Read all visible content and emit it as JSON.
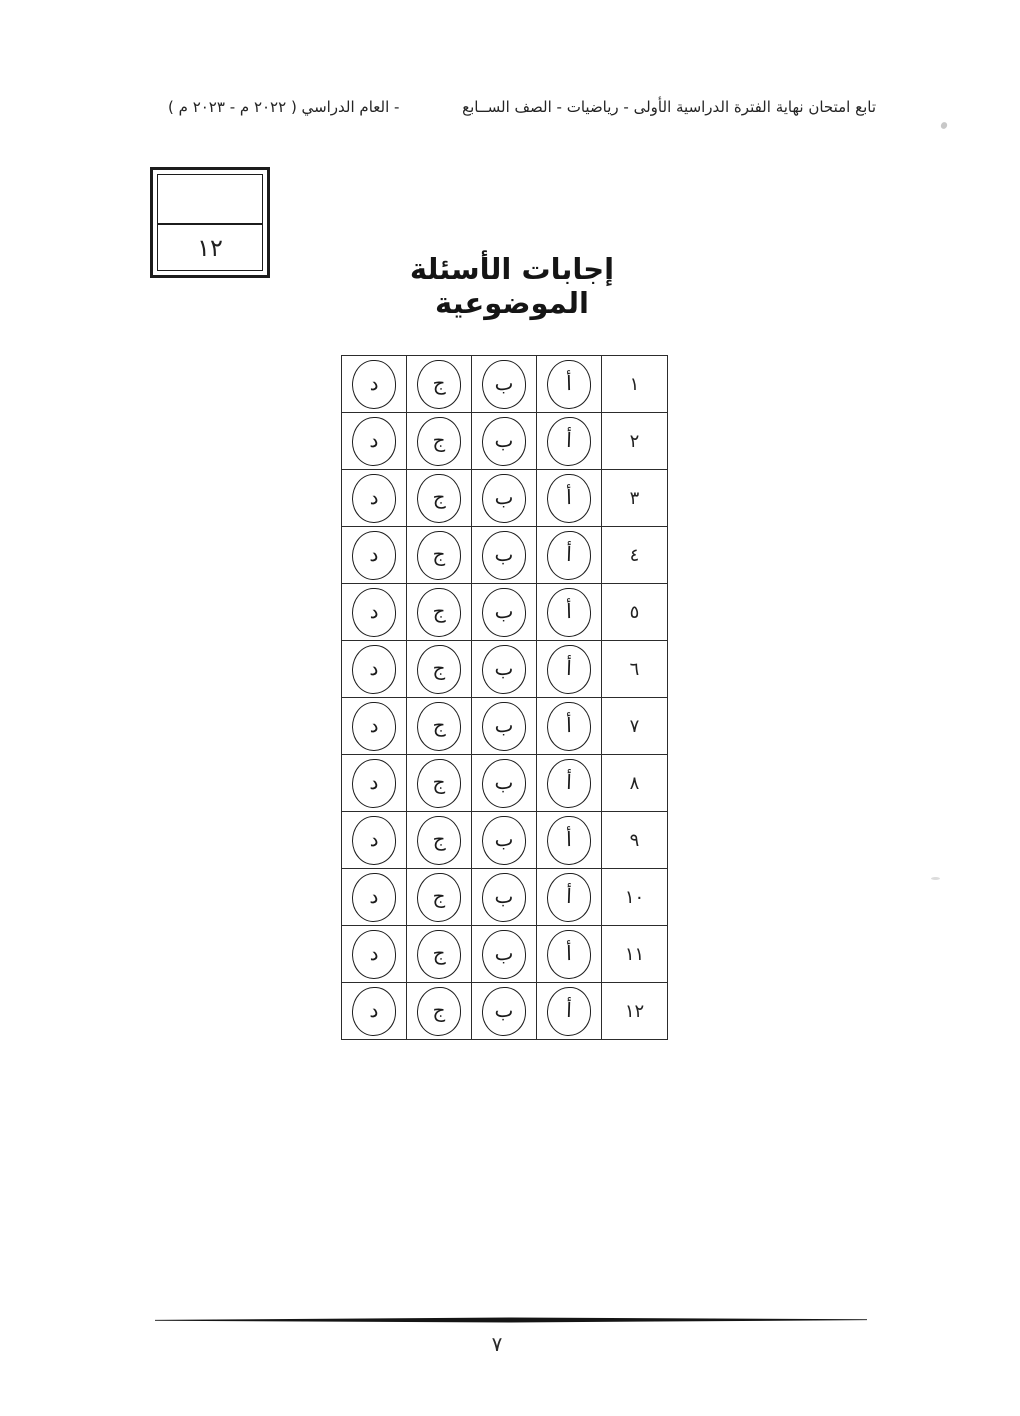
{
  "header": {
    "right_text": "تابع   امتحان نهاية الفترة الدراسية الأولى -  رياضيات - الصف الســابع",
    "left_text": "-  العام الدراسي ( ٢٠٢٢ م  -  ٢٠٢٣ م )"
  },
  "grade_box": {
    "top_value": "",
    "score": "١٢"
  },
  "title": "إجابات الأسئلة الموضوعية",
  "answer_table": {
    "options": [
      "أ",
      "ب",
      "ج",
      "د"
    ],
    "rows": [
      {
        "number": "١",
        "choices": [
          "أ",
          "ب",
          "ج",
          "د"
        ]
      },
      {
        "number": "٢",
        "choices": [
          "أ",
          "ب",
          "ج",
          "د"
        ]
      },
      {
        "number": "٣",
        "choices": [
          "أ",
          "ب",
          "ج",
          "د"
        ]
      },
      {
        "number": "٤",
        "choices": [
          "أ",
          "ب",
          "ج",
          "د"
        ]
      },
      {
        "number": "٥",
        "choices": [
          "أ",
          "ب",
          "ج",
          "د"
        ]
      },
      {
        "number": "٦",
        "choices": [
          "أ",
          "ب",
          "ج",
          "د"
        ]
      },
      {
        "number": "٧",
        "choices": [
          "أ",
          "ب",
          "ج",
          "د"
        ]
      },
      {
        "number": "٨",
        "choices": [
          "أ",
          "ب",
          "ج",
          "د"
        ]
      },
      {
        "number": "٩",
        "choices": [
          "أ",
          "ب",
          "ج",
          "د"
        ]
      },
      {
        "number": "١٠",
        "choices": [
          "أ",
          "ب",
          "ج",
          "د"
        ]
      },
      {
        "number": "١١",
        "choices": [
          "أ",
          "ب",
          "ج",
          "د"
        ]
      },
      {
        "number": "١٢",
        "choices": [
          "أ",
          "ب",
          "ج",
          "د"
        ]
      }
    ]
  },
  "footer": {
    "page_number": "٧"
  },
  "colors": {
    "ink": "#1b1b1b",
    "paper": "#ffffff"
  }
}
